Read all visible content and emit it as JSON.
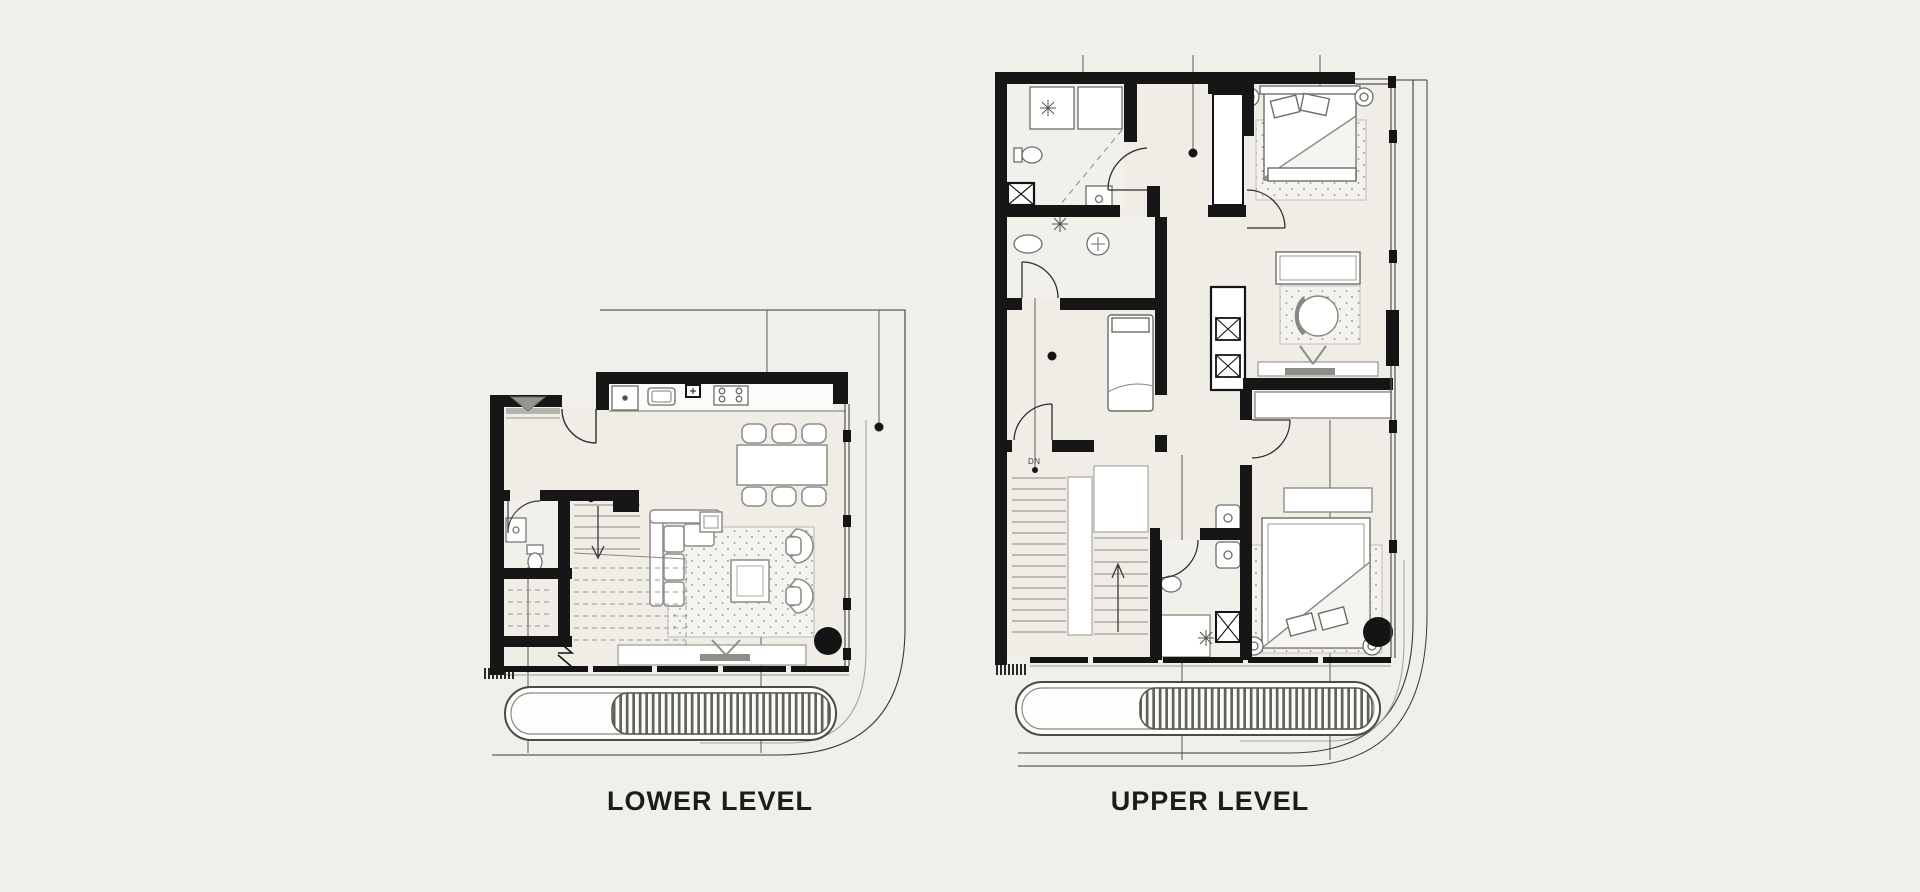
{
  "page": {
    "background_color": "#f1efe9",
    "wall_color": "#161616",
    "floor_color": "#efede6",
    "line_gray": "#8e8c87"
  },
  "plans": {
    "lower": {
      "label": "LOWER LEVEL",
      "rooms": [
        "entry",
        "powder-room",
        "storage",
        "staircase",
        "kitchen",
        "dining",
        "living",
        "balcony"
      ],
      "fixtures": [
        "entry-marker",
        "kitchen-counter",
        "refrigerator",
        "sink",
        "cooktop",
        "pendant-light",
        "dining-table",
        "dining-chairs",
        "sofa",
        "rug",
        "coffee-table",
        "armchairs",
        "tv-console",
        "toilet",
        "basin",
        "stairs-up",
        "louvre-screen",
        "column"
      ]
    },
    "upper": {
      "label": "UPPER LEVEL",
      "stair_direction_label": "DN",
      "rooms": [
        "bathroom",
        "ensuite",
        "corridor",
        "master-bedroom",
        "bedroom-2",
        "bedroom-3",
        "staircase",
        "balcony"
      ],
      "fixtures": [
        "laundry-units",
        "shower",
        "toilet",
        "vanity-basin",
        "duct-shaft",
        "wardrobe",
        "double-bed",
        "single-bed",
        "bedside-lamps",
        "desk",
        "round-chair",
        "tv-console",
        "pendant-light",
        "louvre-screen",
        "column"
      ]
    }
  }
}
